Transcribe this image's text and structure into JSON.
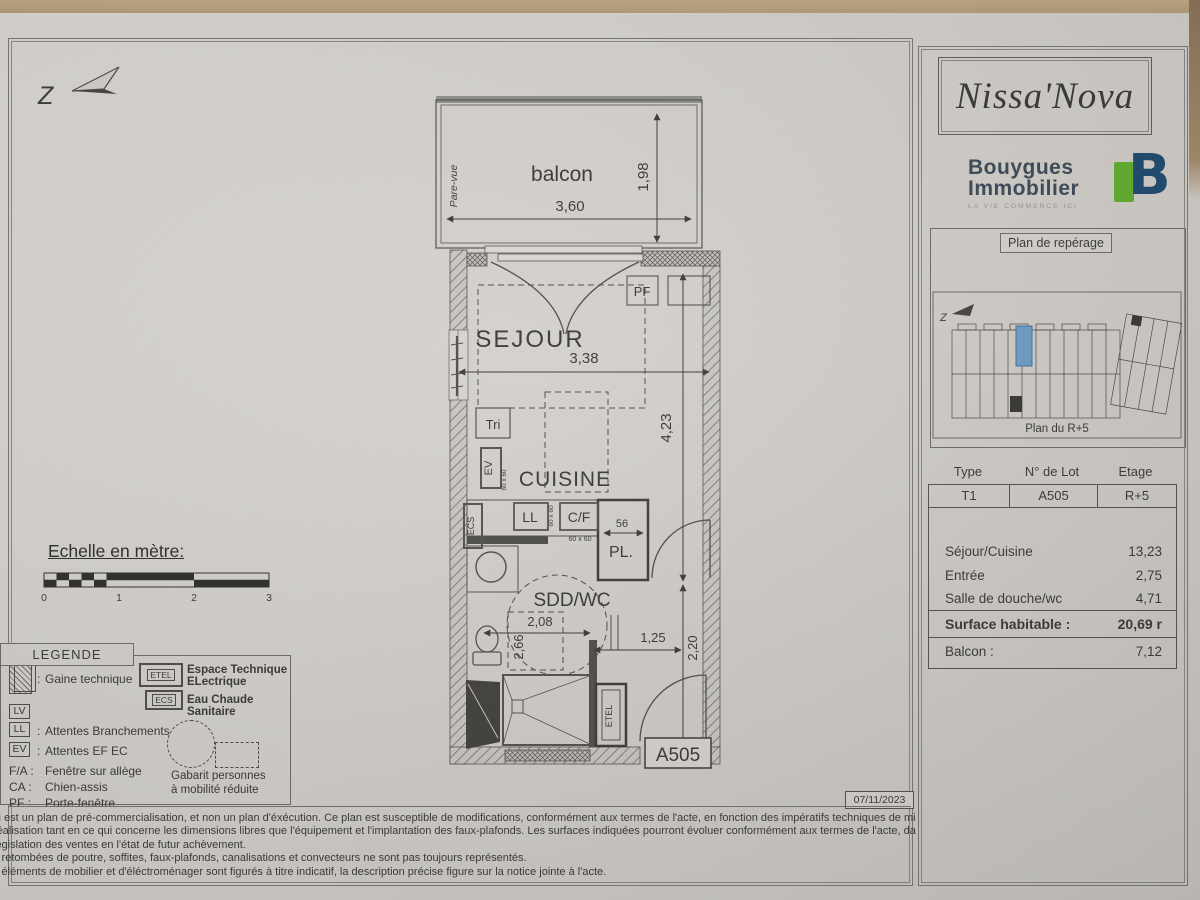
{
  "date": "07/11/2023",
  "colors": {
    "paper": "#d3d0cb",
    "ink": "#3a3a38",
    "accent_blue_unit": "#6e9bc5",
    "brand_navy": "#204a6e",
    "brand_green": "#61ae2e"
  },
  "branding": {
    "project": "Nissa'Nova",
    "company_line1": "Bouygues",
    "company_line2": "Immobilier",
    "tagline": "LA VIE COMMENCE ICI",
    "logo_letter": "B"
  },
  "reperage": {
    "title": "Plan de repérage",
    "caption": "Plan du R+5",
    "north": "Z"
  },
  "lot_table": {
    "headers": [
      "Type",
      "N° de Lot",
      "Etage"
    ],
    "row": [
      "T1",
      "A505",
      "R+5"
    ]
  },
  "surfaces": {
    "rows": [
      {
        "label": "Séjour/Cuisine",
        "value": "13,23"
      },
      {
        "label": "Entrée",
        "value": "2,75"
      },
      {
        "label": "Salle de douche/wc",
        "value": "4,71"
      }
    ],
    "total_label": "Surface habitable :",
    "total_value": "20,69 r",
    "balcony_label": "Balcon :",
    "balcony_value": "7,12"
  },
  "plan": {
    "north": "Z",
    "balcon": "balcon",
    "balcon_w": "3,60",
    "balcon_h": "1,98",
    "pare_vue": "Pare-vue",
    "sejour": "SEJOUR",
    "sejour_w": "3,38",
    "h_main": "4,23",
    "h_entry": "2,20",
    "w_entry": "1,25",
    "pf": "PF",
    "tri": "Tri",
    "ev": "EV",
    "size60": "60 x 60",
    "cuisine": "CUISINE",
    "ecs": "ECS",
    "ll": "LL",
    "cf": "C/F",
    "dim56": "56",
    "pl": "PL.",
    "sdd": "SDD/WC",
    "sdd_w": "2,08",
    "sdd_h": "2,66",
    "etel": "ETEL",
    "lot": "A505"
  },
  "scale": {
    "title": "Echelle en mètre:",
    "ticks": [
      "0",
      "1",
      "2",
      "3"
    ]
  },
  "legend": {
    "title": "LEGENDE",
    "sep": ":",
    "gaine": "Gaine technique",
    "etel_abbr": "ETEL",
    "etel_1": "Espace Technique",
    "etel_2": "ELectrique",
    "ecs_abbr": "ECS",
    "ecs_label": "Eau Chaude Sanitaire",
    "lv": "LV",
    "ll": "LL",
    "attentes_b": "Attentes Branchements",
    "ev": "EV",
    "attentes_ef": "Attentes EF EC",
    "fa": "F/A :",
    "fenetre": "Fenêtre sur allège",
    "ca": "CA :",
    "chien": "Chien-assis",
    "pf": "PF :",
    "porte": "Porte-fenêtre",
    "gabarit_1": "Gabarit personnes",
    "gabarit_2": "à mobilité réduite"
  },
  "disclaimer": {
    "lines": [
      "ci est un plan de pré-commercialisation, et non un plan d'éxécution. Ce plan est susceptible de modifications, conformément aux termes de l'acte, en fonction des impératifs techniques de mise en œuvre,",
      "réalisation tant en ce qui concerne les dimensions libres que l'équipement et l'implantation des faux-plafonds. Les surfaces indiquées pourront évoluer conformément aux termes de l'acte, dans le cadre de",
      "législation des ventes en l'état de futur achèvement.",
      "s retombées de poutre, soffites, faux-plafonds, canalisations et convecteurs ne sont pas toujours représentés.",
      "s éléments de mobilier et d'éléctroménager sont figurés à titre indicatif, la description précise figure sur la notice jointe à l'acte."
    ]
  }
}
